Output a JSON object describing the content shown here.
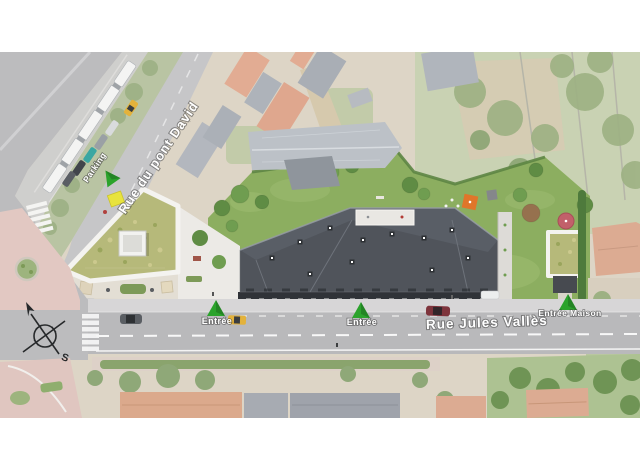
{
  "scene": {
    "streets": {
      "rue_du_pont_david": "Rue du pont David",
      "rue_jules_valles": "Rue Jules Vallès"
    },
    "markers": {
      "parking": "Parking",
      "entrance_left": "Entrée",
      "entrance_center": "Entrée",
      "entrance_maison": "Entrée Maison"
    },
    "compass": {
      "south": "S"
    },
    "colors": {
      "marker_green": "#2ba32c",
      "main_roof_grey": "#50545b",
      "sedum_green": "#b6b97a",
      "lawn_green": "#8cae60",
      "road_grey": "#bcbcbe",
      "plaza_pink": "#e2c8c2",
      "taxi_yellow": "#e3b23b",
      "label_white": "#ffffff"
    }
  }
}
